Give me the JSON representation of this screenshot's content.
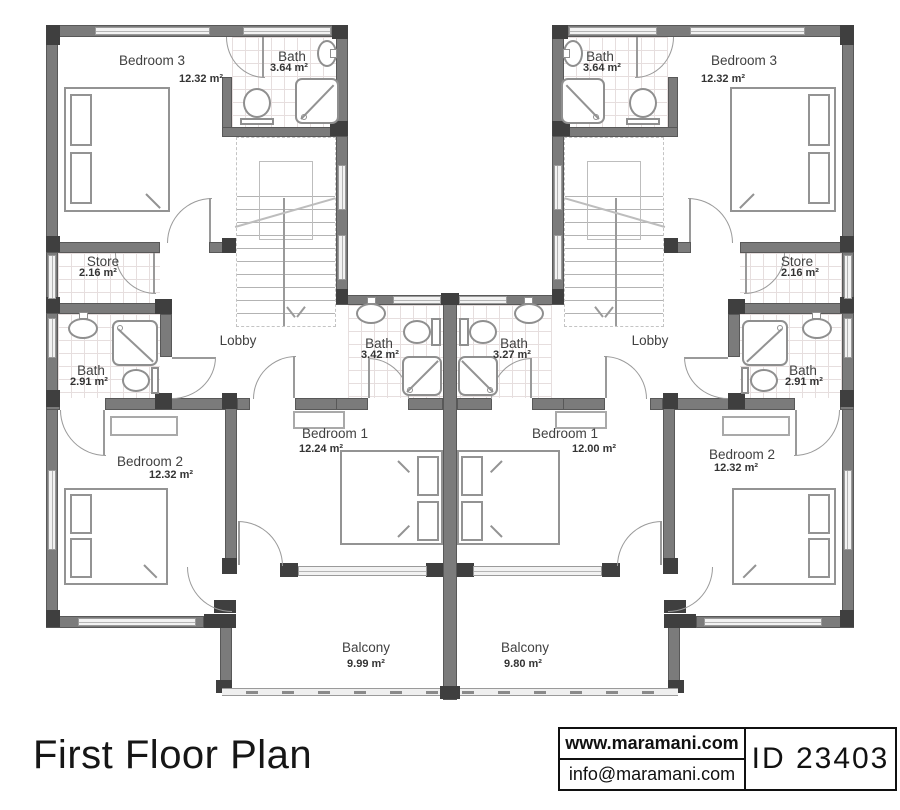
{
  "title": "First Floor Plan",
  "footer": {
    "website": "www.maramani.com",
    "email": "info@maramani.com",
    "plan_id": "ID 23403"
  },
  "units": {
    "left": {
      "bedroom3": {
        "name": "Bedroom 3",
        "area": "12.32 m²"
      },
      "bath_top": {
        "name": "Bath",
        "area": "3.64 m²"
      },
      "store": {
        "name": "Store",
        "area": "2.16 m²"
      },
      "bath_side": {
        "name": "Bath",
        "area": "2.91 m²"
      },
      "lobby": {
        "name": "Lobby"
      },
      "bedroom2": {
        "name": "Bedroom 2",
        "area": "12.32 m²"
      },
      "bedroom1": {
        "name": "Bedroom 1",
        "area": "12.24 m²"
      },
      "bath_center": {
        "name": "Bath",
        "area": "3.42 m²"
      },
      "balcony": {
        "name": "Balcony",
        "area": "9.99 m²"
      }
    },
    "right": {
      "bedroom3": {
        "name": "Bedroom 3",
        "area": "12.32 m²"
      },
      "bath_top": {
        "name": "Bath",
        "area": "3.64 m²"
      },
      "store": {
        "name": "Store",
        "area": "2.16 m²"
      },
      "bath_side": {
        "name": "Bath",
        "area": "2.91 m²"
      },
      "lobby": {
        "name": "Lobby"
      },
      "bedroom2": {
        "name": "Bedroom 2",
        "area": "12.32 m²"
      },
      "bedroom1": {
        "name": "Bedroom 1",
        "area": "12.00 m²"
      },
      "bath_center": {
        "name": "Bath",
        "area": "3.27 m²"
      },
      "balcony": {
        "name": "Balcony",
        "area": "9.80 m²"
      }
    }
  },
  "colors": {
    "wall": "#7b7b7b",
    "wall_dark": "#3f3f3f",
    "line": "#9a9a9a",
    "furniture": "#939393"
  }
}
